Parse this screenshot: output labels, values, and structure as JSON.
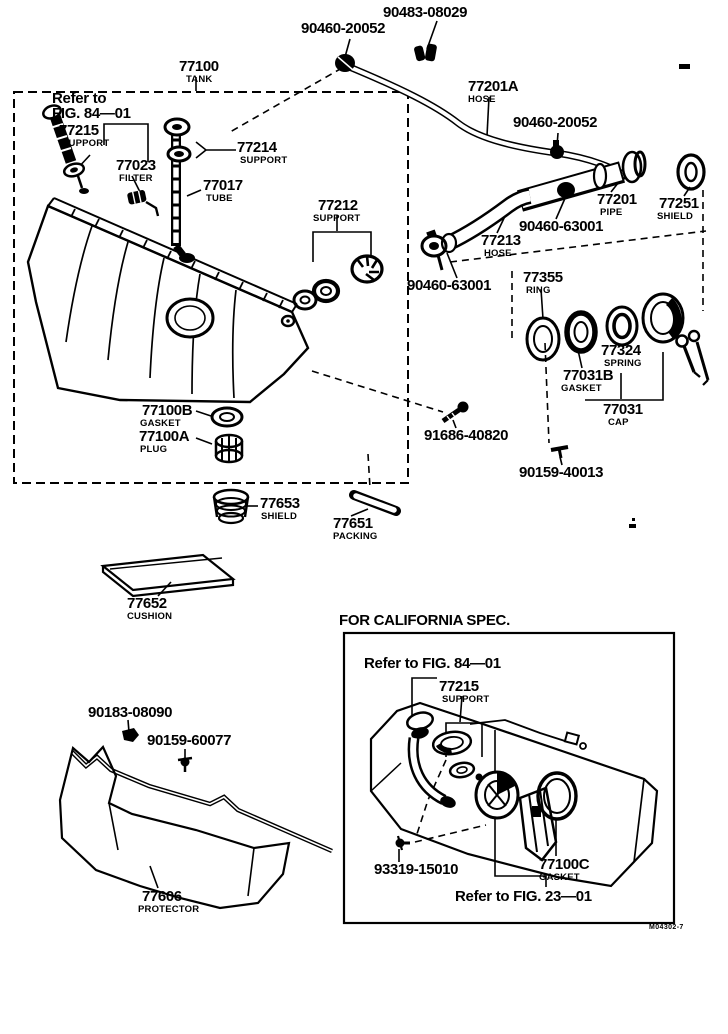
{
  "page": {
    "background": "#ffffff",
    "ink": "#000000",
    "description": "Fuel tank and tube parts diagram"
  },
  "notes": {
    "refer_main_line1": "Refer to",
    "refer_main_line2": "FIG. 84—01",
    "california_title": "FOR CALIFORNIA SPEC.",
    "ca_refer_top": "Refer to FIG. 84—01",
    "ca_refer_bottom": "Refer to FIG. 23—01",
    "footer_code": "M04302-7"
  },
  "labels": [
    {
      "number": "90483-08029",
      "name": ""
    },
    {
      "number": "90460-20052",
      "name": ""
    },
    {
      "number": "77100",
      "name": "TANK"
    },
    {
      "number": "77215",
      "name": "SUPPORT"
    },
    {
      "number": "77023",
      "name": "FILTER"
    },
    {
      "number": "77214",
      "name": "SUPPORT"
    },
    {
      "number": "77017",
      "name": "TUBE"
    },
    {
      "number": "77212",
      "name": "SUPPORT"
    },
    {
      "number": "77201A",
      "name": "HOSE"
    },
    {
      "number": "90460-20052",
      "name": ""
    },
    {
      "number": "77201",
      "name": "PIPE"
    },
    {
      "number": "77251",
      "name": "SHIELD"
    },
    {
      "number": "90460-63001",
      "name": ""
    },
    {
      "number": "77213",
      "name": "HOSE"
    },
    {
      "number": "90460-63001",
      "name": ""
    },
    {
      "number": "77355",
      "name": "RING"
    },
    {
      "number": "77324",
      "name": "SPRING"
    },
    {
      "number": "77031B",
      "name": "GASKET"
    },
    {
      "number": "77031",
      "name": "CAP"
    },
    {
      "number": "91686-40820",
      "name": ""
    },
    {
      "number": "90159-40013",
      "name": ""
    },
    {
      "number": "77100B",
      "name": "GASKET"
    },
    {
      "number": "77100A",
      "name": "PLUG"
    },
    {
      "number": "77653",
      "name": "SHIELD"
    },
    {
      "number": "77651",
      "name": "PACKING"
    },
    {
      "number": "77652",
      "name": "CUSHION"
    },
    {
      "number": "90183-08090",
      "name": ""
    },
    {
      "number": "90159-60077",
      "name": ""
    },
    {
      "number": "77606",
      "name": "PROTECTOR"
    },
    {
      "number": "77215",
      "name": "SUPPORT"
    },
    {
      "number": "93319-15010",
      "name": ""
    },
    {
      "number": "77100C",
      "name": "GASKET"
    }
  ]
}
